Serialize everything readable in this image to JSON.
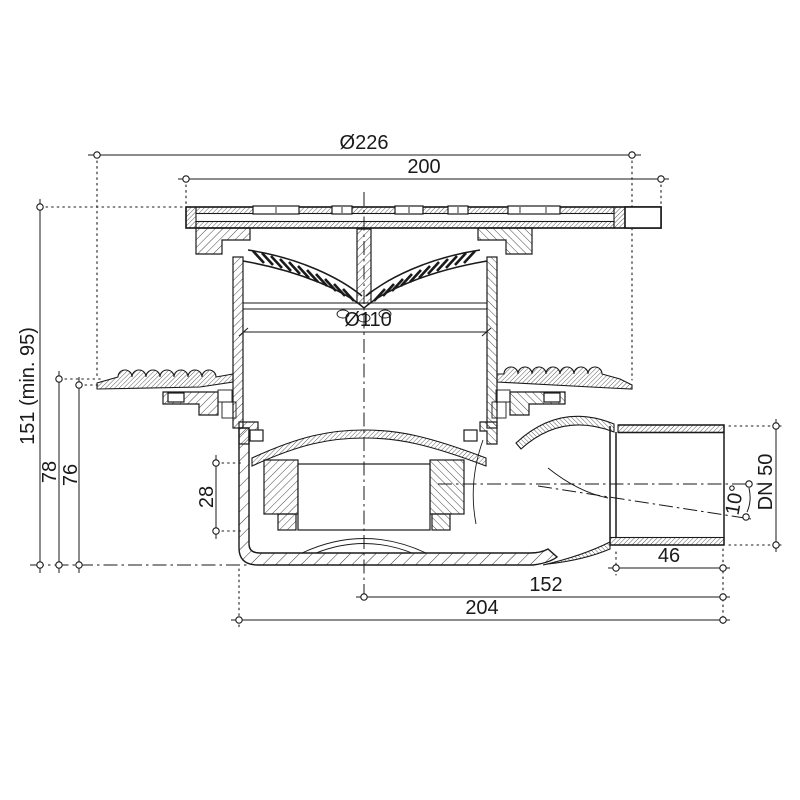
{
  "dims": {
    "d226": "Ø226",
    "w200": "200",
    "d110": "Ø110",
    "h151": "151 (min. 95)",
    "h78": "78",
    "h76": "76",
    "h28": "28",
    "dn50": "DN 50",
    "angle10": "10°",
    "l46": "46",
    "l152": "152",
    "l204": "204"
  },
  "colors": {
    "line": "#1a1a1a",
    "background": "#ffffff"
  }
}
